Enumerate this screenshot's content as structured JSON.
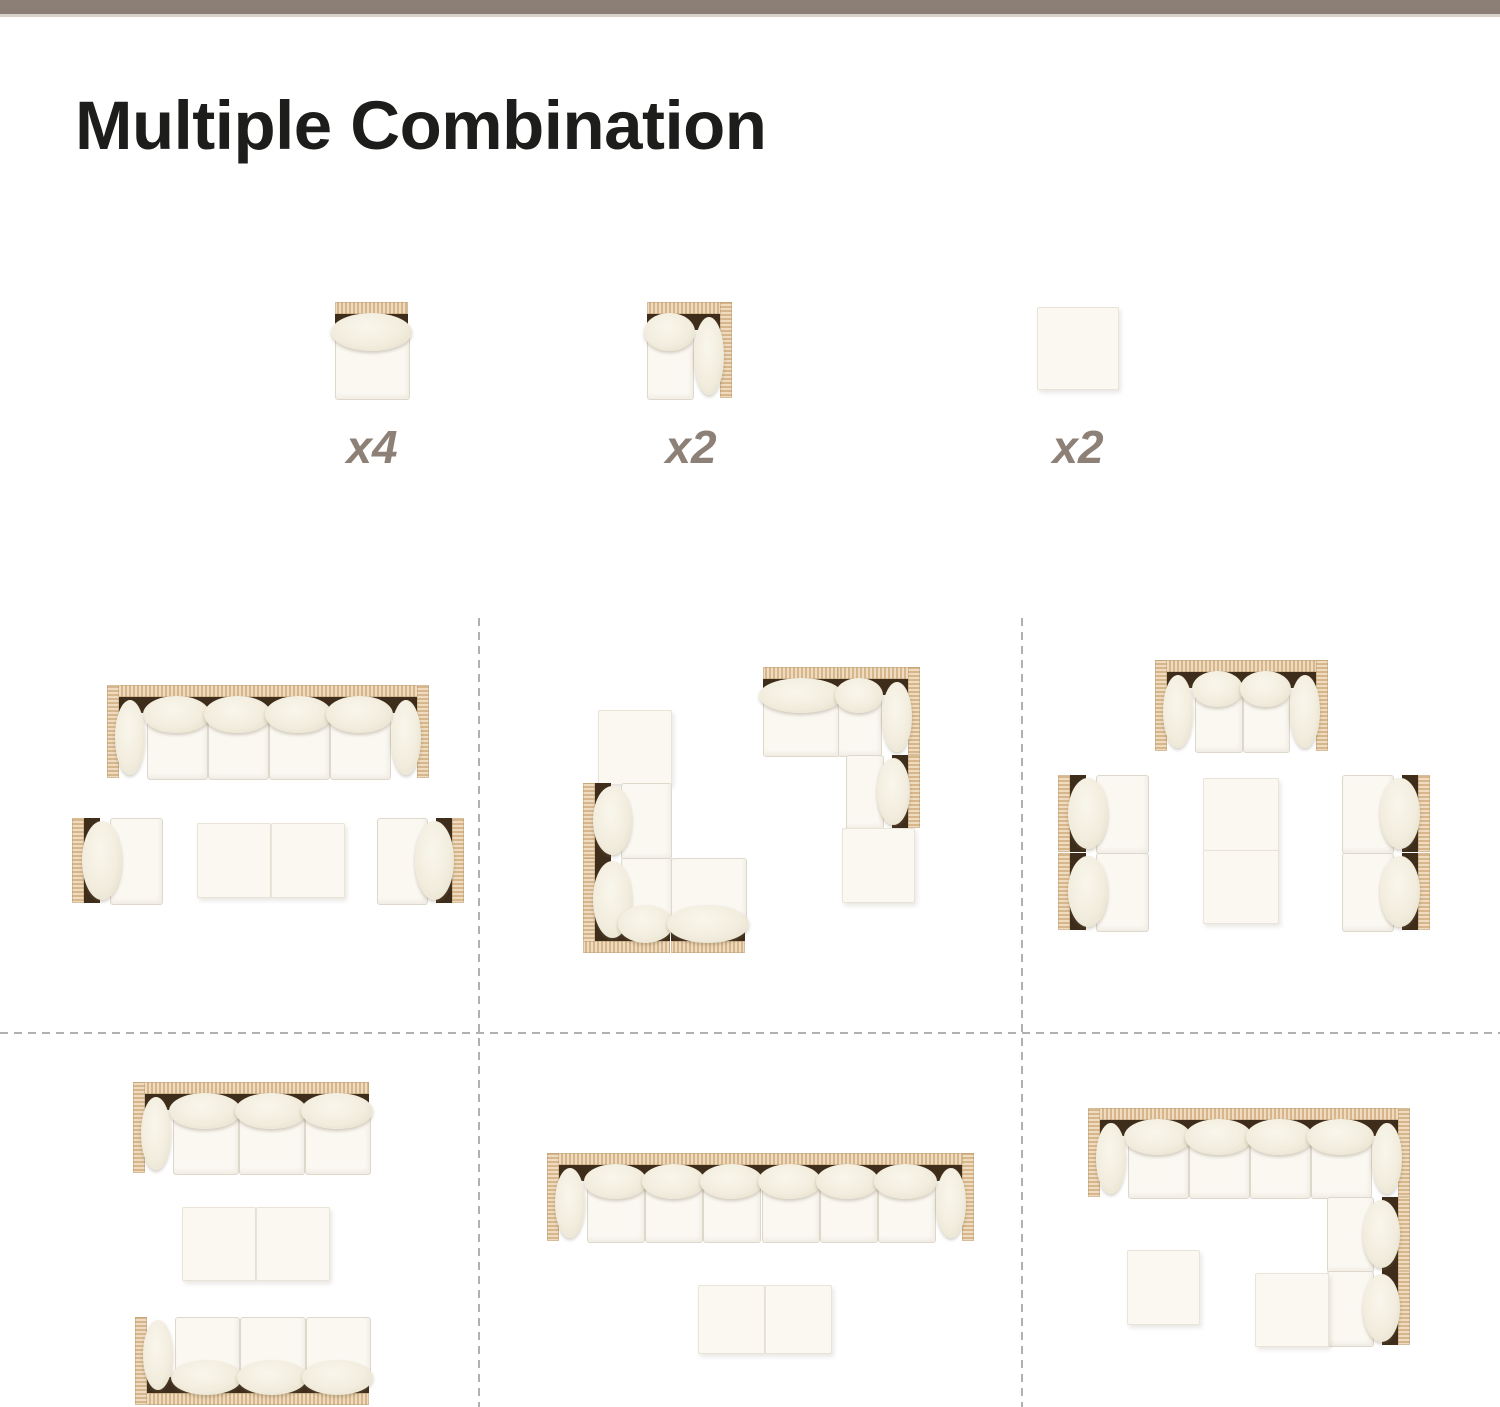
{
  "meta": {
    "title": "Multiple Combination"
  },
  "colors": {
    "top_bar": "#8c7f75",
    "top_bar_edge": "#d8d2cb",
    "title_text": "#1d1d1b",
    "count_label_text": "#8d8076",
    "wicker_frame": "#e6c89f",
    "cushion": "#f2edde",
    "seat": "#fbf8f2",
    "frame_shadow": "#3f2d1b",
    "divider_dash": "#b3b0ad",
    "background": "#ffffff"
  },
  "legend": {
    "items": [
      {
        "piece": "armless-middle-chair",
        "count_label": "x4"
      },
      {
        "piece": "corner-chair",
        "count_label": "x2"
      },
      {
        "piece": "ottoman",
        "count_label": "x2"
      }
    ]
  },
  "figures": {
    "legend_pieces": [
      {
        "id": "legend-armless-chair",
        "x": 335,
        "y": 302,
        "w": 73,
        "h": 96,
        "wicker": [
          "top"
        ],
        "back": [
          "top"
        ]
      },
      {
        "id": "legend-corner-chair",
        "x": 647,
        "y": 302,
        "w": 85,
        "h": 96,
        "wicker": [
          "top",
          "right"
        ],
        "back": [
          "top"
        ],
        "bolsters": [
          "right"
        ]
      },
      {
        "id": "legend-ottoman",
        "x": 1037,
        "y": 307,
        "w": 80,
        "h": 81,
        "plain": true
      }
    ],
    "combinations": [
      {
        "id": "combo-1",
        "pieces": [
          {
            "id": "sofa-4-seat",
            "x": 107,
            "y": 685,
            "w": 322,
            "h": 93,
            "seats": 4,
            "wicker": [
              "top",
              "left",
              "right"
            ],
            "back": [
              "top"
            ],
            "bolsters": [
              "left",
              "right"
            ]
          },
          {
            "id": "corner-chair-facing-right",
            "x": 72,
            "y": 818,
            "w": 89,
            "h": 85,
            "wicker": [
              "left"
            ],
            "back": [
              "left"
            ]
          },
          {
            "id": "ottoman",
            "x": 197,
            "y": 823,
            "w": 72,
            "h": 73,
            "plain": true
          },
          {
            "id": "ottoman",
            "x": 271,
            "y": 823,
            "w": 72,
            "h": 73,
            "plain": true
          },
          {
            "id": "corner-chair-facing-left",
            "x": 377,
            "y": 818,
            "w": 87,
            "h": 85,
            "wicker": [
              "right"
            ],
            "back": [
              "right"
            ]
          }
        ]
      },
      {
        "id": "combo-2",
        "pieces": [
          {
            "id": "ottoman",
            "x": 598,
            "y": 710,
            "w": 72,
            "h": 73,
            "plain": true
          },
          {
            "id": "chair-facing-right",
            "x": 583,
            "y": 783,
            "w": 87,
            "h": 75,
            "wicker": [
              "left"
            ],
            "back": [
              "left"
            ]
          },
          {
            "id": "corner-unit",
            "x": 583,
            "y": 858,
            "w": 87,
            "h": 95,
            "wicker": [
              "left",
              "bottom"
            ],
            "back": [
              "left",
              "bottom"
            ]
          },
          {
            "id": "chair-facing-up",
            "x": 671,
            "y": 858,
            "w": 74,
            "h": 95,
            "wicker": [
              "bottom"
            ],
            "back": [
              "bottom"
            ]
          },
          {
            "id": "chair-facing-down",
            "x": 763,
            "y": 667,
            "w": 75,
            "h": 88,
            "wicker": [
              "top"
            ],
            "back": [
              "top"
            ]
          },
          {
            "id": "corner-unit",
            "x": 838,
            "y": 667,
            "w": 82,
            "h": 88,
            "wicker": [
              "top",
              "right"
            ],
            "back": [
              "top"
            ],
            "bolsters": [
              "right"
            ]
          },
          {
            "id": "chair-facing-left",
            "x": 846,
            "y": 755,
            "w": 74,
            "h": 73,
            "wicker": [
              "right"
            ],
            "back": [
              "right"
            ]
          },
          {
            "id": "ottoman",
            "x": 842,
            "y": 828,
            "w": 71,
            "h": 73,
            "plain": true
          }
        ]
      },
      {
        "id": "combo-3",
        "pieces": [
          {
            "id": "loveseat-2-seat",
            "x": 1155,
            "y": 660,
            "w": 173,
            "h": 91,
            "seats": 2,
            "wicker": [
              "top",
              "left",
              "right"
            ],
            "back": [
              "top"
            ],
            "bolsters": [
              "left",
              "right"
            ]
          },
          {
            "id": "chair-facing-right",
            "x": 1058,
            "y": 775,
            "w": 89,
            "h": 77,
            "wicker": [
              "left"
            ],
            "back": [
              "left"
            ]
          },
          {
            "id": "chair-facing-right",
            "x": 1058,
            "y": 853,
            "w": 89,
            "h": 77,
            "wicker": [
              "left"
            ],
            "back": [
              "left"
            ]
          },
          {
            "id": "ottoman",
            "x": 1203,
            "y": 778,
            "w": 74,
            "h": 71,
            "plain": true
          },
          {
            "id": "ottoman",
            "x": 1203,
            "y": 850,
            "w": 74,
            "h": 72,
            "plain": true
          },
          {
            "id": "chair-facing-left",
            "x": 1342,
            "y": 775,
            "w": 88,
            "h": 77,
            "wicker": [
              "right"
            ],
            "back": [
              "right"
            ]
          },
          {
            "id": "chair-facing-left",
            "x": 1342,
            "y": 853,
            "w": 88,
            "h": 77,
            "wicker": [
              "right"
            ],
            "back": [
              "right"
            ]
          }
        ]
      },
      {
        "id": "combo-4",
        "pieces": [
          {
            "id": "sofa-3-seat-left-arm",
            "x": 133,
            "y": 1082,
            "w": 236,
            "h": 91,
            "seats": 3,
            "wicker": [
              "top",
              "left"
            ],
            "back": [
              "top"
            ],
            "bolsters": [
              "left"
            ]
          },
          {
            "id": "ottoman",
            "x": 182,
            "y": 1207,
            "w": 72,
            "h": 72,
            "plain": true
          },
          {
            "id": "ottoman",
            "x": 256,
            "y": 1207,
            "w": 72,
            "h": 72,
            "plain": true
          },
          {
            "id": "sofa-3-seat-left-arm-flipped",
            "x": 135,
            "y": 1317,
            "w": 234,
            "h": 88,
            "seats": 3,
            "wicker": [
              "bottom",
              "left"
            ],
            "back": [
              "bottom"
            ],
            "bolsters": [
              "left"
            ]
          }
        ]
      },
      {
        "id": "combo-5",
        "pieces": [
          {
            "id": "sofa-6-seat",
            "x": 547,
            "y": 1153,
            "w": 427,
            "h": 88,
            "seats": 6,
            "wicker": [
              "top",
              "left",
              "right"
            ],
            "back": [
              "top"
            ],
            "bolsters": [
              "left",
              "right"
            ]
          },
          {
            "id": "ottoman",
            "x": 698,
            "y": 1285,
            "w": 65,
            "h": 67,
            "plain": true
          },
          {
            "id": "ottoman",
            "x": 765,
            "y": 1285,
            "w": 65,
            "h": 67,
            "plain": true
          }
        ]
      },
      {
        "id": "combo-6",
        "pieces": [
          {
            "id": "sofa-4-seat-corner",
            "x": 1088,
            "y": 1108,
            "w": 322,
            "h": 89,
            "seats": 4,
            "wicker": [
              "top",
              "left",
              "right"
            ],
            "back": [
              "top"
            ],
            "bolsters": [
              "left",
              "right"
            ]
          },
          {
            "id": "chair-facing-left",
            "x": 1327,
            "y": 1197,
            "w": 83,
            "h": 74,
            "wicker": [
              "right"
            ],
            "back": [
              "right"
            ]
          },
          {
            "id": "chair-facing-left",
            "x": 1327,
            "y": 1271,
            "w": 83,
            "h": 74,
            "wicker": [
              "right"
            ],
            "back": [
              "right"
            ]
          },
          {
            "id": "ottoman",
            "x": 1255,
            "y": 1273,
            "w": 72,
            "h": 72,
            "plain": true
          },
          {
            "id": "ottoman",
            "x": 1127,
            "y": 1250,
            "w": 71,
            "h": 73,
            "plain": true
          }
        ]
      }
    ]
  }
}
